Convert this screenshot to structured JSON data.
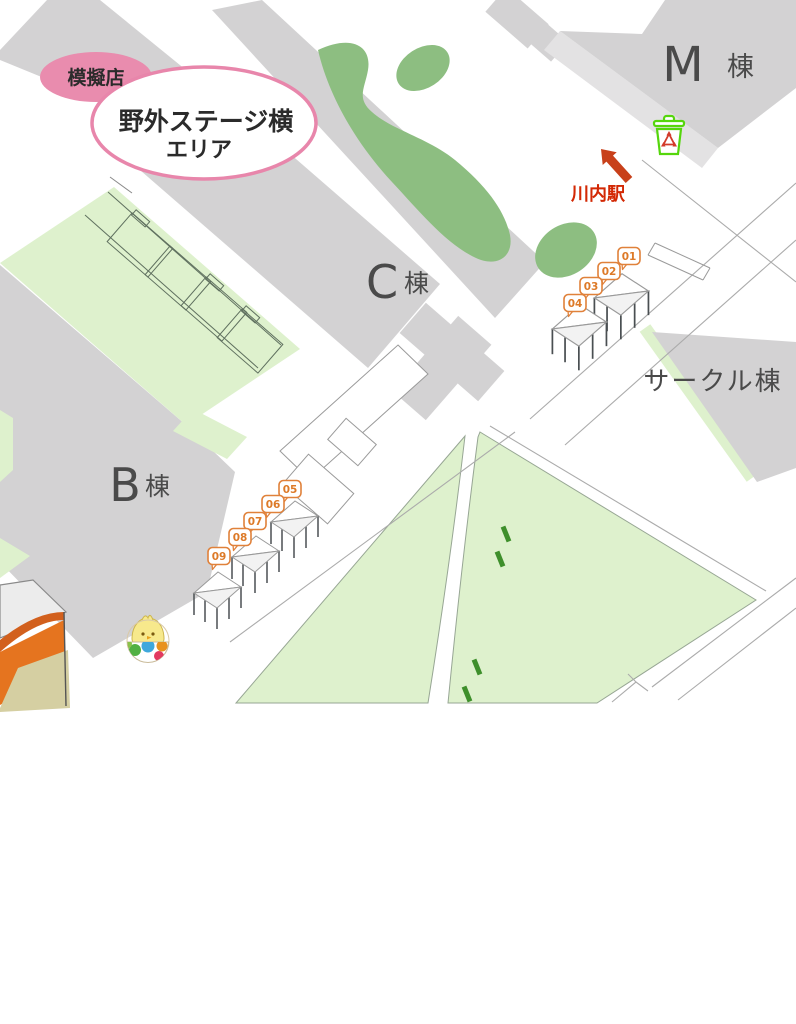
{
  "map": {
    "title_bubble": {
      "category": "模擬店",
      "area_line1": "野外ステージ横",
      "area_line2": "エリア"
    },
    "buildings": {
      "m": {
        "letter": "M",
        "suffix": "棟"
      },
      "c": {
        "letter": "C",
        "suffix": "棟"
      },
      "b": {
        "letter": "B",
        "suffix": "棟"
      },
      "circle_hall": {
        "name": "サークル棟"
      }
    },
    "station": {
      "name": "川内駅"
    },
    "stalls": {
      "roadside_row": [
        "01",
        "02",
        "03",
        "04"
      ],
      "b_building_row": [
        "05",
        "06",
        "07",
        "08",
        "09"
      ]
    },
    "icons": {
      "recycle_bin": "recycle-bin",
      "direction_arrow": "arrow-to-station",
      "mascot": "chick-in-cup-mascot"
    },
    "colors": {
      "building_gray": "#d3d2d3",
      "walkway_gray": "#e3e2e3",
      "grass_light": "#def1cd",
      "tree_green": "#8dbe81",
      "path_dash_green": "#3e8f2b",
      "bubble_pink": "#e98cae",
      "stall_label_orange": "#e0813a",
      "station_red": "#c8401a",
      "bin_green": "#55d60c",
      "stage_orange": "#e5741f"
    }
  }
}
